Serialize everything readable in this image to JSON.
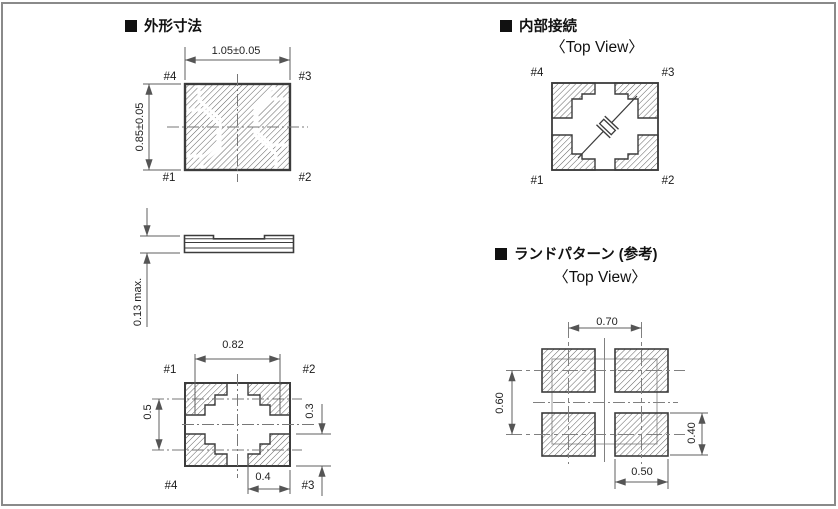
{
  "colors": {
    "line": "#3c3c3c",
    "dimension": "#5f5f5f",
    "hatch": "#606060",
    "frame": "#8a8a8a",
    "text": "#1b1b1b",
    "background": "#ffffff"
  },
  "sections": {
    "outline": {
      "title": "外形寸法"
    },
    "internal": {
      "title": "内部接続",
      "view_label": "〈Top View〉"
    },
    "land": {
      "title": "ランドパターン (参考)",
      "view_label": "〈Top View〉"
    }
  },
  "outline_top_view": {
    "dim_width": "1.05±0.05",
    "dim_height": "0.85±0.05",
    "pin_top_left": "#4",
    "pin_top_right": "#3",
    "pin_bottom_left": "#1",
    "pin_bottom_right": "#2"
  },
  "side_view": {
    "dim_thickness": "0.13 max."
  },
  "bottom_view": {
    "dim_pad_pitch_x": "0.82",
    "dim_pad_pitch_y": "0.5",
    "dim_pad_height": "0.3",
    "dim_pad_width": "0.4",
    "pin_top_left": "#1",
    "pin_top_right": "#2",
    "pin_bottom_left": "#4",
    "pin_bottom_right": "#3"
  },
  "internal_view": {
    "pin_top_left": "#4",
    "pin_top_right": "#3",
    "pin_bottom_left": "#1",
    "pin_bottom_right": "#2"
  },
  "land_pattern": {
    "dim_pad_pitch_x": "0.70",
    "dim_pad_pitch_y": "0.60",
    "dim_pad_height": "0.40",
    "dim_pad_width": "0.50"
  }
}
